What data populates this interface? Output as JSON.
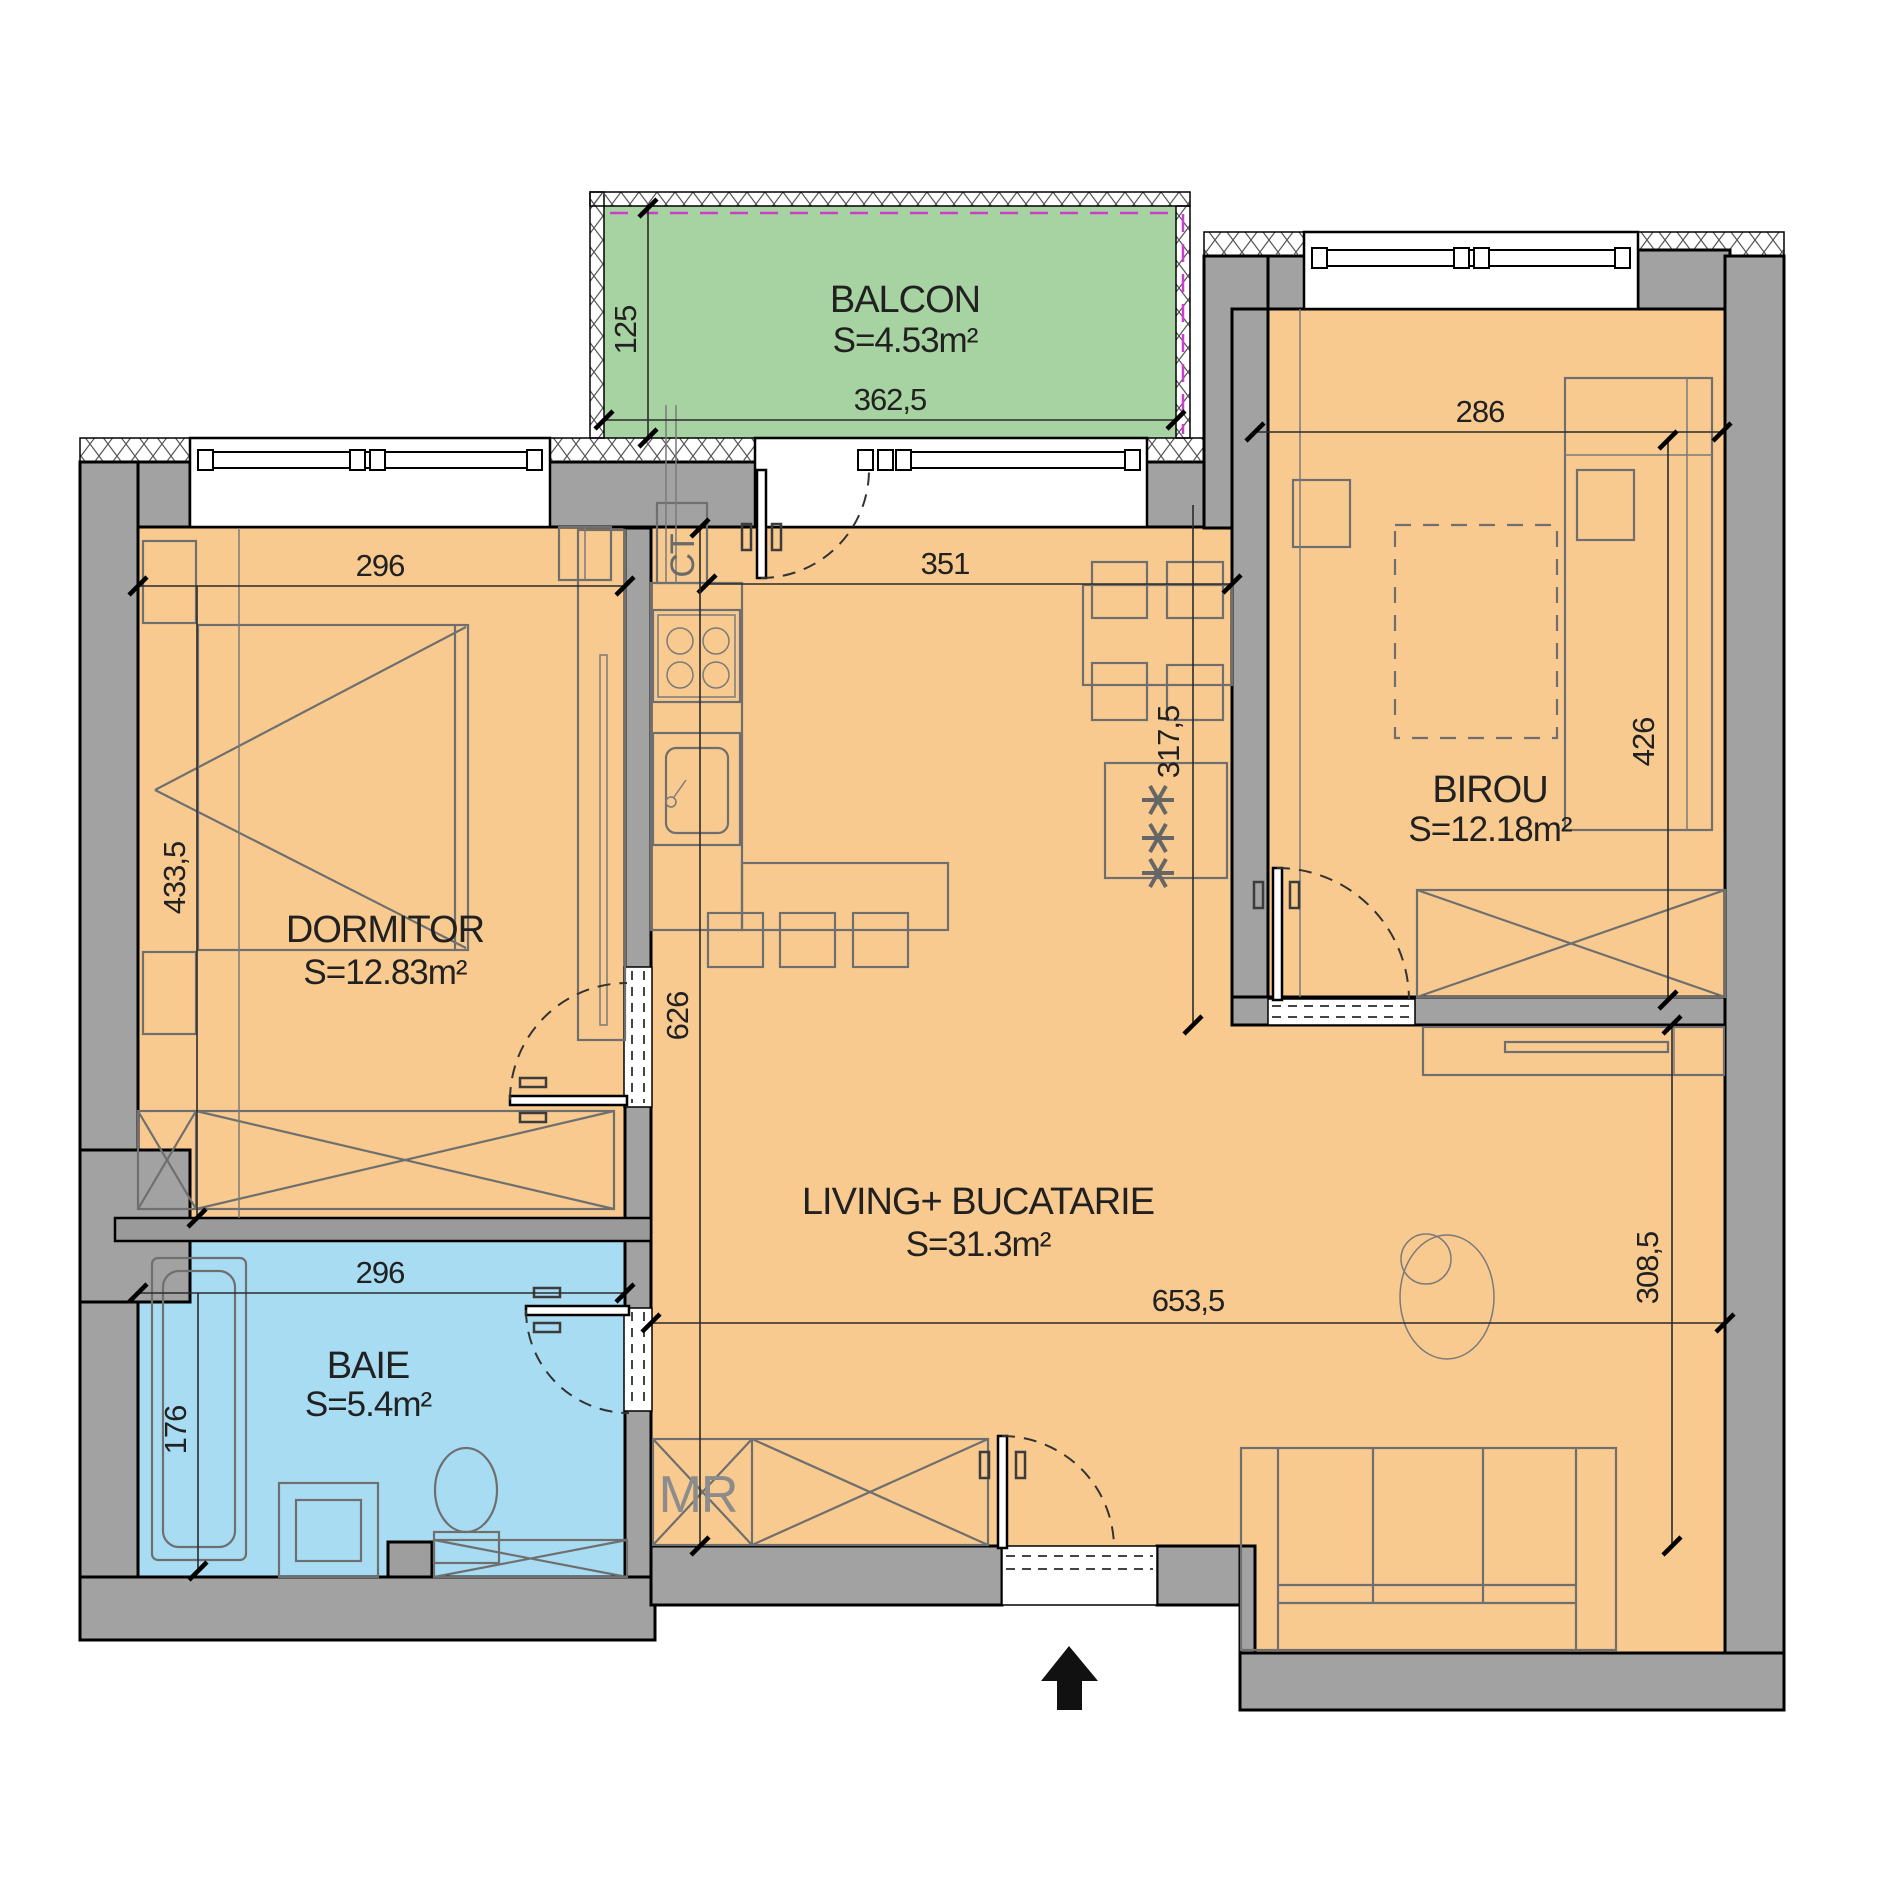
{
  "plan": {
    "rooms": {
      "balcon": {
        "name": "BALCON",
        "area": "S=4.53m²"
      },
      "dormitor": {
        "name": "DORMITOR",
        "area": "S=12.83m²"
      },
      "baie": {
        "name": "BAIE",
        "area": "S=5.4m²"
      },
      "living": {
        "name": "LIVING+ BUCATARIE",
        "area": "S=31.3m²"
      },
      "birou": {
        "name": "BIROU",
        "area": "S=12.18m²"
      }
    },
    "annotations": {
      "boiler": "CT",
      "washer": "MR"
    },
    "dimensions": {
      "balcon_depth": "125",
      "balcon_width": "362,5",
      "dormitor_width": "296",
      "dormitor_depth": "433,5",
      "baie_width": "296",
      "baie_depth": "176",
      "kitchen_width": "351",
      "kitchen_depth": "317,5",
      "living_depth": "626",
      "living_width": "653,5",
      "birou_width": "286",
      "birou_depth": "426",
      "living_right_depth": "308,5"
    },
    "colors": {
      "floor": "#f8ca8f",
      "balcony": "#a7d2a1",
      "bathroom": "#a8dcf2",
      "wall": "#a2a2a2",
      "railing_magenta": "#c93fc9"
    }
  }
}
